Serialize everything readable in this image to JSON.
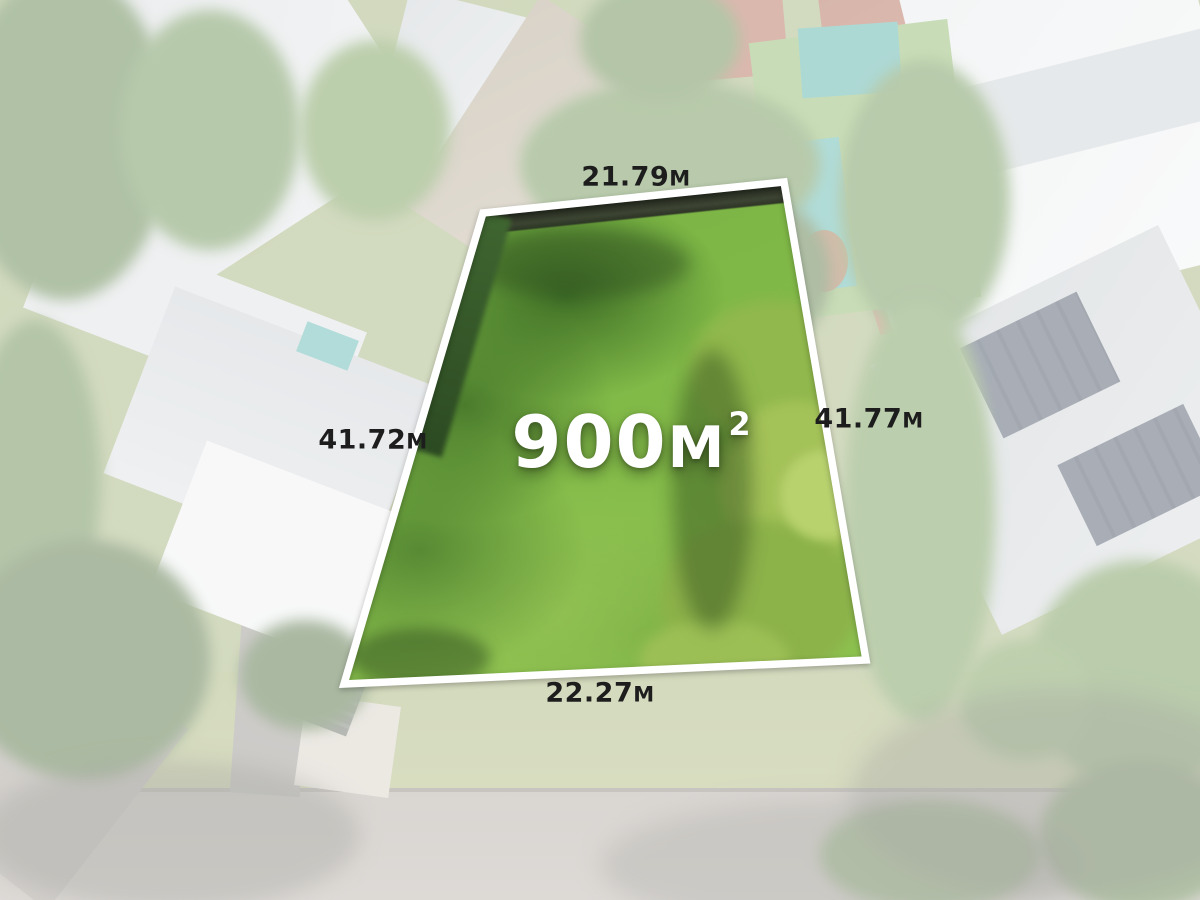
{
  "image": {
    "kind": "aerial-real-estate-photo",
    "alt": "Aerial drone view of a suburban block with a vacant land lot highlighted in bright green; surroundings are faded white"
  },
  "lot": {
    "area": {
      "value": "900",
      "unit": "M",
      "superscript": "2"
    },
    "dimensions": {
      "top": {
        "value": "21.79",
        "unit": "M"
      },
      "right": {
        "value": "41.77",
        "unit": "M"
      },
      "left": {
        "value": "41.72",
        "unit": "M"
      },
      "bottom": {
        "value": "22.27",
        "unit": "M"
      }
    }
  },
  "colors": {
    "lot_grass": "#7db544",
    "lot_grass_dark": "#44702c",
    "lot_outline": "#ffffff",
    "dimension_text": "#1d1d1d",
    "area_text": "#ffffff",
    "fade_overlay": "rgba(255,255,255,0.56)"
  }
}
